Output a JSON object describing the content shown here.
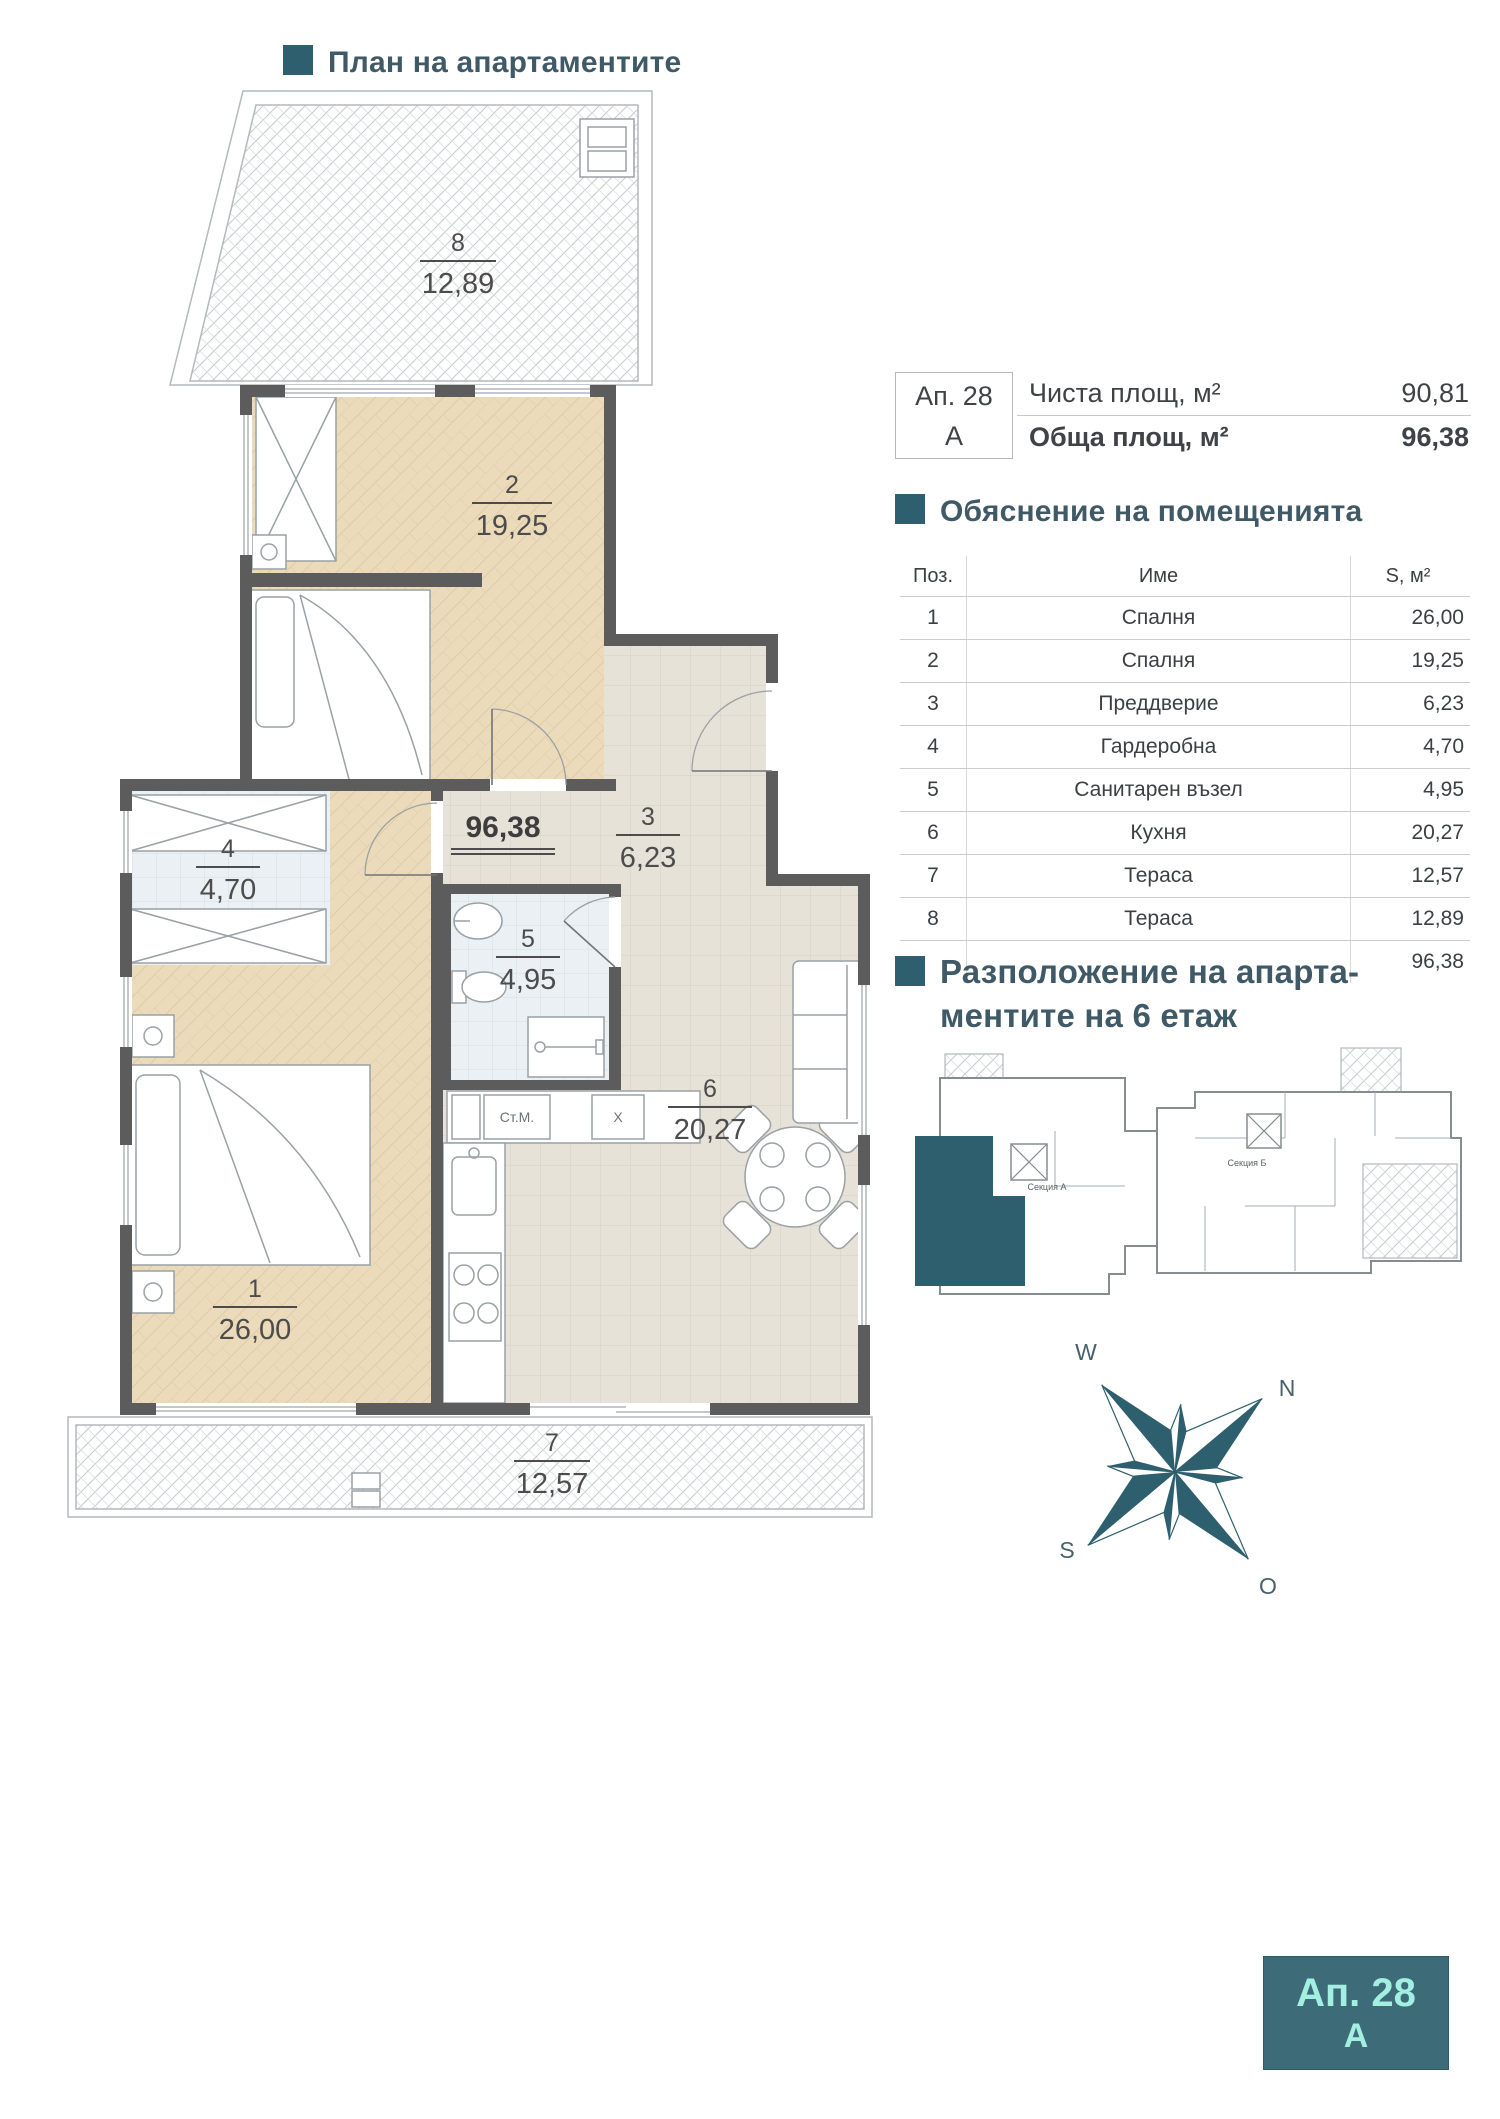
{
  "header": {
    "title": "План на апартаментите"
  },
  "colors": {
    "accent": "#2e5f6e",
    "wall": "#5c5c5c",
    "badge_bg": "#3d6b78",
    "badge_text": "#a3efe2"
  },
  "apartment_info": {
    "id_top": "Ап. 28",
    "id_bottom": "А",
    "row1_label": "Чиста площ, м²",
    "row1_value": "90,81",
    "row2_label": "Обща площ, м²",
    "row2_value": "96,38"
  },
  "legend": {
    "title": "Обяснение на помещенията",
    "col_pos": "Поз.",
    "col_name": "Име",
    "col_area": "S, м²",
    "rows": [
      [
        "1",
        "Спалня",
        "26,00"
      ],
      [
        "2",
        "Спалня",
        "19,25"
      ],
      [
        "3",
        "Преддверие",
        "6,23"
      ],
      [
        "4",
        "Гардеробна",
        "4,70"
      ],
      [
        "5",
        "Санитарен възел",
        "4,95"
      ],
      [
        "6",
        "Кухня",
        "20,27"
      ],
      [
        "7",
        "Тераса",
        "12,57"
      ],
      [
        "8",
        "Тераса",
        "12,89"
      ]
    ],
    "total": "96,38"
  },
  "location": {
    "title_line1": "Разположение на апарта-",
    "title_line2": "ментите на 6 етаж",
    "section_a": "Секция А",
    "section_b": "Секция Б"
  },
  "plan": {
    "total": "96,38",
    "washer": "Ст.М.",
    "x_box": "X",
    "rooms": [
      {
        "num": "1",
        "area": "26,00"
      },
      {
        "num": "2",
        "area": "19,25"
      },
      {
        "num": "3",
        "area": "6,23"
      },
      {
        "num": "4",
        "area": "4,70"
      },
      {
        "num": "5",
        "area": "4,95"
      },
      {
        "num": "6",
        "area": "20,27"
      },
      {
        "num": "7",
        "area": "12,57"
      },
      {
        "num": "8",
        "area": "12,89"
      }
    ]
  },
  "compass": {
    "w": "W",
    "n": "N",
    "s": "S",
    "o": "O"
  },
  "badge": {
    "line1": "Ап. 28",
    "line2": "А"
  }
}
